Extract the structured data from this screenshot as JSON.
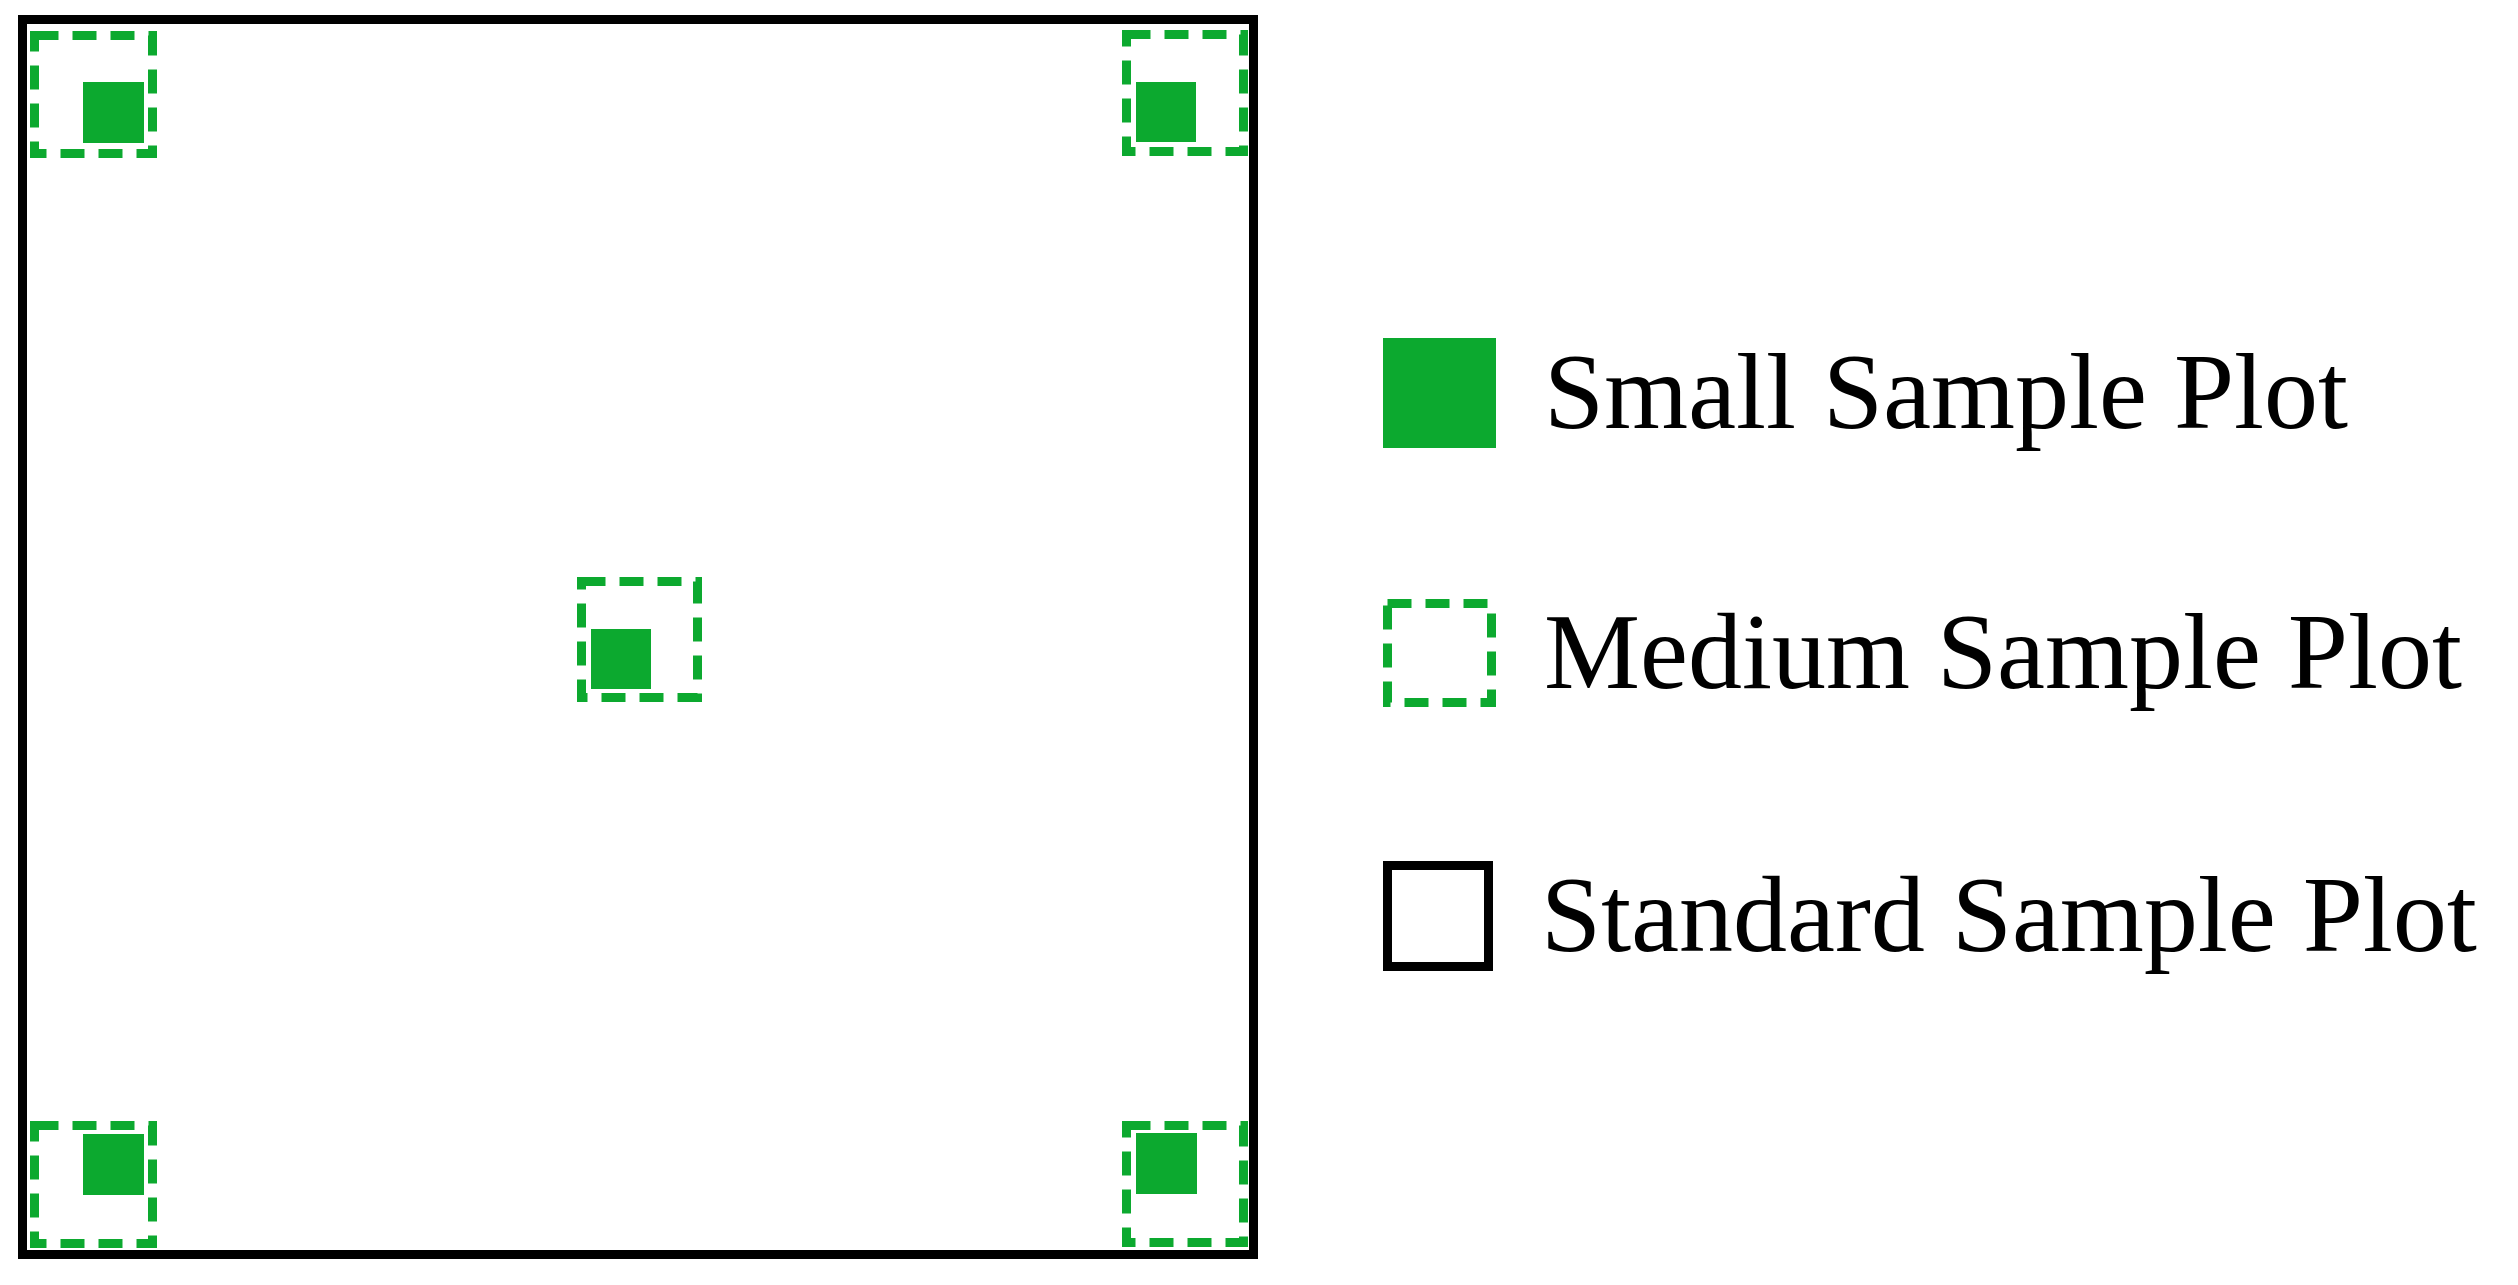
{
  "figure": {
    "colors": {
      "green": "#0ca92f",
      "black": "#000000",
      "background": "#ffffff"
    },
    "standard_plot": {
      "x": 18,
      "y": 15,
      "width": 1240,
      "height": 1244,
      "border": 9
    },
    "marker_style": {
      "dash_length": 24,
      "dash_gap": 14,
      "stroke_width": 9
    },
    "markers": [
      {
        "position": "top-left",
        "dashed": {
          "x": 30,
          "y": 31,
          "size": 127
        },
        "solid": {
          "x": 83,
          "y": 82,
          "size": 61
        }
      },
      {
        "position": "top-right",
        "dashed": {
          "x": 1122,
          "y": 30,
          "size": 126
        },
        "solid": {
          "x": 1136,
          "y": 82,
          "size": 60
        }
      },
      {
        "position": "center",
        "dashed": {
          "x": 577,
          "y": 577,
          "size": 125
        },
        "solid": {
          "x": 591,
          "y": 629,
          "size": 60
        }
      },
      {
        "position": "bottom-left",
        "dashed": {
          "x": 30,
          "y": 1121,
          "size": 127
        },
        "solid": {
          "x": 83,
          "y": 1134,
          "size": 61
        }
      },
      {
        "position": "bottom-right",
        "dashed": {
          "x": 1122,
          "y": 1121,
          "size": 126
        },
        "solid": {
          "x": 1136,
          "y": 1133,
          "size": 61
        }
      }
    ]
  },
  "legend": {
    "rows_y": [
      338,
      599,
      861
    ],
    "items": [
      {
        "label": "Small Sample Plot",
        "swatch": "solid-green-square"
      },
      {
        "label": "Medium Sample Plot",
        "swatch": "dashed-green-square"
      },
      {
        "label": "Standard Sample Plot",
        "swatch": "black-outline-square"
      }
    ]
  }
}
